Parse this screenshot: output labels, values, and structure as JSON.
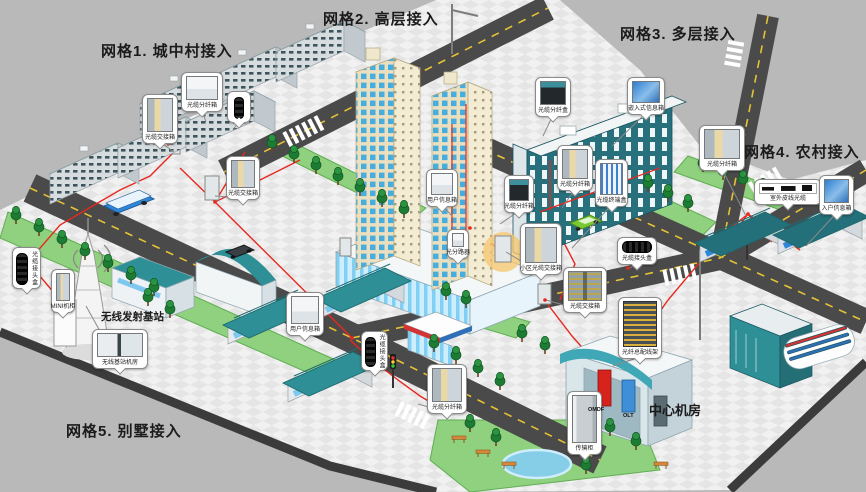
{
  "labels": {
    "grid1": "网格1. 城中村接入",
    "grid2": "网格2. 高层接入",
    "grid3": "网格3. 多层接入",
    "grid4": "网格4. 农村接入",
    "grid5": "网格5. 别墅接入",
    "wireless_station": "无线发射基站",
    "central_office": "中心机房",
    "omdf": "OMDF",
    "olt": "OLT"
  },
  "callouts": [
    {
      "id": "co1",
      "label": "光缆交接箱",
      "icon": "cabinet-open"
    },
    {
      "id": "co2",
      "label": "光缆分纤箱",
      "icon": "wall-box"
    },
    {
      "id": "co3",
      "label": "",
      "icon": "cable-closure-vertical"
    },
    {
      "id": "co4",
      "label": "光缆交接箱",
      "icon": "cabinet-open"
    },
    {
      "id": "co5",
      "label": "用户信息箱",
      "icon": "wall-box"
    },
    {
      "id": "co6",
      "label": "光分路器",
      "icon": "wall-box"
    },
    {
      "id": "co7",
      "label": "光缆分纤箱",
      "icon": "splitter-box"
    },
    {
      "id": "co8",
      "label": "小区光缆交接箱",
      "icon": "cabinet-open"
    },
    {
      "id": "co9",
      "label": "光缆分纤盒",
      "icon": "splitter-box"
    },
    {
      "id": "co10",
      "label": "嵌入式信息箱",
      "icon": "pcb-board"
    },
    {
      "id": "co11",
      "label": "光缆分纤箱",
      "icon": "cabinet-open"
    },
    {
      "id": "co12",
      "label": "光缆终端盒",
      "icon": "odf-strips"
    },
    {
      "id": "co13",
      "label": "光缆分纤箱",
      "icon": "cabinet-open"
    },
    {
      "id": "co14",
      "label": "室外皮线光缆",
      "icon": "drop-cable-fittings"
    },
    {
      "id": "co15",
      "label": "入户信息箱",
      "icon": "pcb-board"
    },
    {
      "id": "co16",
      "label": "光缆接头盒",
      "icon": "cable-closure-vertical"
    },
    {
      "id": "co17",
      "label": "MINI机柜",
      "icon": "cabinet-open"
    },
    {
      "id": "co18",
      "label": "无线基站机房",
      "icon": "equipment-room"
    },
    {
      "id": "co19",
      "label": "用户信息箱",
      "icon": "wall-box"
    },
    {
      "id": "co20",
      "label": "光缆接头盒",
      "icon": "cable-closure-vertical"
    },
    {
      "id": "co21",
      "label": "光缆分纤箱",
      "icon": "cabinet-open"
    },
    {
      "id": "co22",
      "label": "光缆交接箱",
      "icon": "cabinet-open-double"
    },
    {
      "id": "co23",
      "label": "光缆接头盒",
      "icon": "cable-closure-horizontal"
    },
    {
      "id": "co24",
      "label": "光纤总配线架",
      "icon": "fiber-rack"
    },
    {
      "id": "co25",
      "label": "传输柜",
      "icon": "gray-rack"
    }
  ],
  "colors": {
    "background": "#b9b9b9",
    "plaza": "#efefef",
    "road": "#4a4a4a",
    "lane_yellow": "#e6c235",
    "lawn": "#8fd17e",
    "roof_teal": "#2e8f96",
    "slab_teal": "#27707c",
    "tower_cream": "#ebdfc0",
    "glass_blue": "#46aede",
    "fiber_red": "#e8281f",
    "omdf_red": "#d6231c",
    "olt_blue": "#3f8fd8"
  }
}
